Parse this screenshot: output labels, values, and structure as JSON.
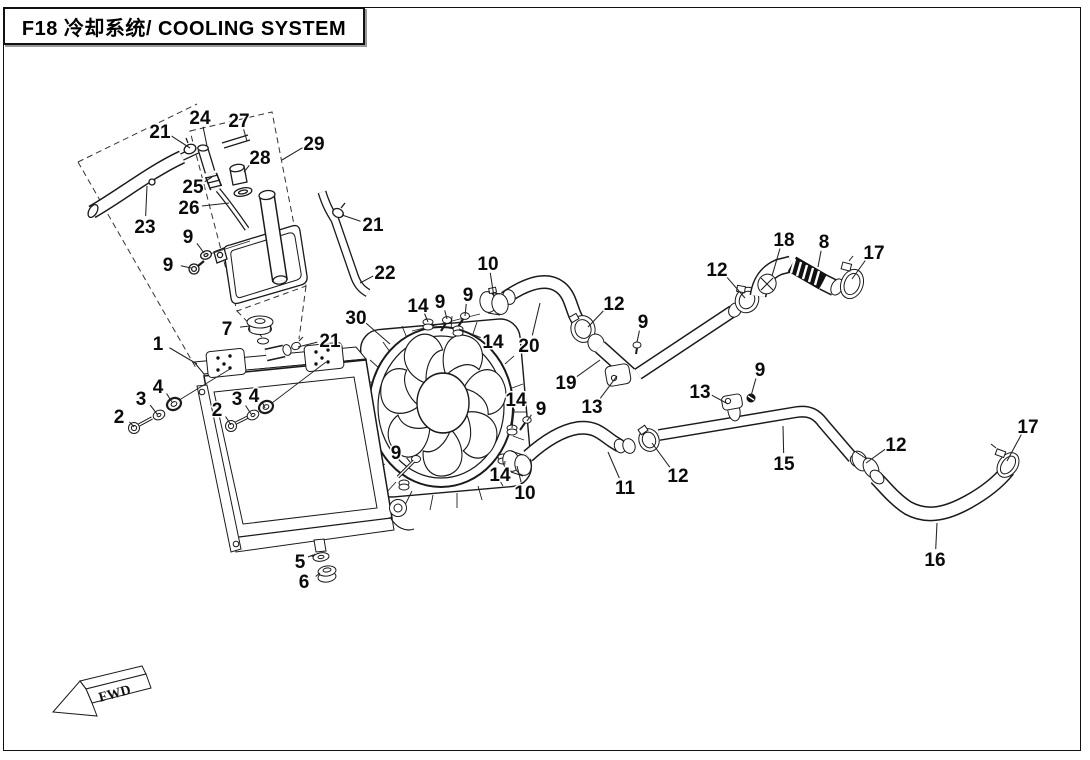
{
  "title": "F18 冷却系统/ COOLING SYSTEM",
  "fwd_label": "FWD",
  "colors": {
    "line": "#1a1a1a",
    "background": "#ffffff"
  },
  "callouts": [
    {
      "label": "21",
      "lx": 160,
      "ly": 131,
      "tx": 190,
      "ty": 148
    },
    {
      "label": "24",
      "lx": 200,
      "ly": 117,
      "tx": 207,
      "ty": 146
    },
    {
      "label": "27",
      "lx": 239,
      "ly": 120,
      "tx": 247,
      "ty": 141
    },
    {
      "label": "29",
      "lx": 314,
      "ly": 143,
      "tx": 282,
      "ty": 160
    },
    {
      "label": "28",
      "lx": 260,
      "ly": 157,
      "tx": 244,
      "ty": 172
    },
    {
      "label": "25",
      "lx": 193,
      "ly": 186,
      "tx": 212,
      "ty": 177
    },
    {
      "label": "26",
      "lx": 189,
      "ly": 207,
      "tx": 229,
      "ty": 203
    },
    {
      "label": "23",
      "lx": 145,
      "ly": 226,
      "tx": 147,
      "ty": 186
    },
    {
      "label": "9",
      "lx": 188,
      "ly": 236,
      "tx": 204,
      "ty": 253
    },
    {
      "label": "9",
      "lx": 168,
      "ly": 264,
      "tx": 191,
      "ty": 268
    },
    {
      "label": "21",
      "lx": 373,
      "ly": 224,
      "tx": 342,
      "ty": 215
    },
    {
      "label": "22",
      "lx": 385,
      "ly": 272,
      "tx": 360,
      "ty": 283
    },
    {
      "label": "7",
      "lx": 227,
      "ly": 328,
      "tx": 250,
      "ty": 326
    },
    {
      "label": "1",
      "lx": 158,
      "ly": 343,
      "tx": 197,
      "ty": 364
    },
    {
      "label": "21",
      "lx": 330,
      "ly": 340,
      "tx": 298,
      "ty": 347
    },
    {
      "label": "30",
      "lx": 356,
      "ly": 317,
      "tx": 390,
      "ty": 344
    },
    {
      "label": "2",
      "lx": 119,
      "ly": 416,
      "tx": 134,
      "ty": 427
    },
    {
      "label": "3",
      "lx": 141,
      "ly": 398,
      "tx": 157,
      "ty": 414
    },
    {
      "label": "4",
      "lx": 158,
      "ly": 386,
      "tx": 172,
      "ty": 402
    },
    {
      "label": "2",
      "lx": 217,
      "ly": 409,
      "tx": 231,
      "ty": 425
    },
    {
      "label": "3",
      "lx": 237,
      "ly": 398,
      "tx": 251,
      "ty": 414
    },
    {
      "label": "4",
      "lx": 254,
      "ly": 395,
      "tx": 265,
      "ty": 408
    },
    {
      "label": "5",
      "lx": 300,
      "ly": 561,
      "tx": 315,
      "ty": 554
    },
    {
      "label": "6",
      "lx": 304,
      "ly": 581,
      "tx": 320,
      "ty": 573
    },
    {
      "label": "14",
      "lx": 418,
      "ly": 305,
      "tx": 428,
      "ty": 322
    },
    {
      "label": "9",
      "lx": 440,
      "ly": 301,
      "tx": 447,
      "ty": 319
    },
    {
      "label": "9",
      "lx": 468,
      "ly": 294,
      "tx": 465,
      "ty": 316
    },
    {
      "label": "14",
      "lx": 493,
      "ly": 341,
      "tx": 459,
      "ty": 329
    },
    {
      "label": "10",
      "lx": 488,
      "ly": 263,
      "tx": 494,
      "ty": 297
    },
    {
      "label": "20",
      "lx": 529,
      "ly": 345,
      "tx": 540,
      "ty": 303
    },
    {
      "label": "12",
      "lx": 614,
      "ly": 303,
      "tx": 588,
      "ty": 327
    },
    {
      "label": "9",
      "lx": 643,
      "ly": 321,
      "tx": 637,
      "ty": 342
    },
    {
      "label": "19",
      "lx": 566,
      "ly": 382,
      "tx": 600,
      "ty": 360
    },
    {
      "label": "13",
      "lx": 592,
      "ly": 406,
      "tx": 617,
      "ty": 376
    },
    {
      "label": "12",
      "lx": 717,
      "ly": 269,
      "tx": 745,
      "ty": 298
    },
    {
      "label": "18",
      "lx": 784,
      "ly": 239,
      "tx": 772,
      "ty": 276
    },
    {
      "label": "8",
      "lx": 824,
      "ly": 241,
      "tx": 818,
      "ty": 267
    },
    {
      "label": "17",
      "lx": 874,
      "ly": 252,
      "tx": 852,
      "ty": 279
    },
    {
      "label": "9",
      "lx": 396,
      "ly": 452,
      "tx": 410,
      "ty": 462
    },
    {
      "label": "14",
      "lx": 516,
      "ly": 399,
      "tx": 512,
      "ty": 428
    },
    {
      "label": "9",
      "lx": 541,
      "ly": 408,
      "tx": 527,
      "ty": 421
    },
    {
      "label": "14",
      "lx": 500,
      "ly": 474,
      "tx": 505,
      "ty": 461
    },
    {
      "label": "10",
      "lx": 525,
      "ly": 492,
      "tx": 517,
      "ty": 466
    },
    {
      "label": "11",
      "lx": 625,
      "ly": 487,
      "tx": 608,
      "ty": 452
    },
    {
      "label": "12",
      "lx": 678,
      "ly": 475,
      "tx": 652,
      "ty": 443
    },
    {
      "label": "13",
      "lx": 700,
      "ly": 391,
      "tx": 728,
      "ty": 404
    },
    {
      "label": "9",
      "lx": 760,
      "ly": 369,
      "tx": 751,
      "ty": 396
    },
    {
      "label": "15",
      "lx": 784,
      "ly": 463,
      "tx": 783,
      "ty": 426
    },
    {
      "label": "12",
      "lx": 896,
      "ly": 444,
      "tx": 866,
      "ty": 463
    },
    {
      "label": "17",
      "lx": 1028,
      "ly": 426,
      "tx": 1007,
      "ty": 461
    },
    {
      "label": "16",
      "lx": 935,
      "ly": 559,
      "tx": 937,
      "ty": 523
    }
  ]
}
